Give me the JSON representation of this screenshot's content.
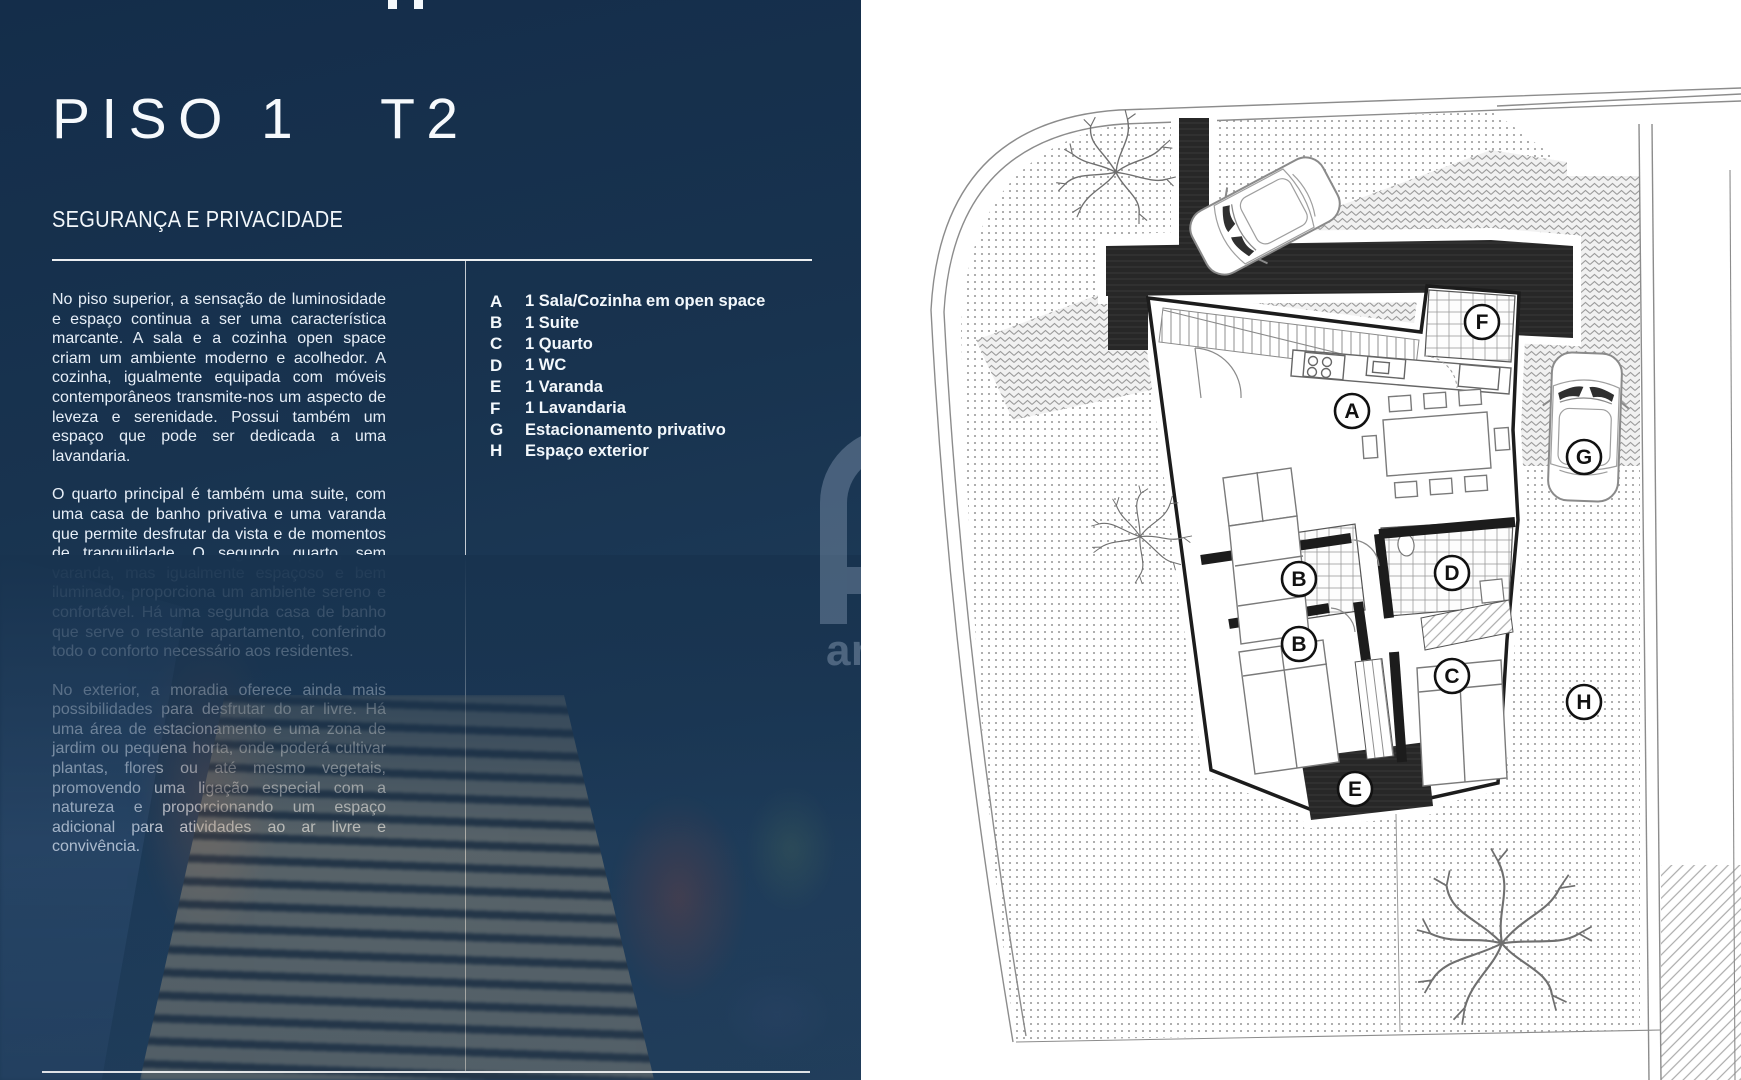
{
  "panel": {
    "title": {
      "left": "PISO 1",
      "right": "T2"
    },
    "subtitle": "SEGURANÇA E PRIVACIDADE",
    "paragraphs": [
      "No piso superior, a sensação de luminosidade e espaço continua a ser uma característica marcante. A sala e a cozinha open space criam um ambiente moderno e acolhedor. A cozinha, igualmente equipada com móveis contemporâneos transmite-nos um aspecto de leveza e serenidade. Possui também um espaço que pode ser dedicada a uma lavandaria.",
      "O quarto principal é também uma suite, com uma casa de banho privativa e uma varanda que permite desfrutar da vista e de momentos de tranquilidade. O segundo quarto, sem varanda, mas igualmente espaçoso e bem iluminado, proporciona um ambiente sereno e confortável. Há uma segunda casa de banho que serve o restante apartamento, conferindo todo o conforto necessário aos residentes.",
      "No exterior, a moradia oferece ainda mais possibilidades para desfrutar do ar livre. Há uma área de estacionamento e uma zona de jardim ou pequena horta, onde poderá cultivar plantas, flores ou até mesmo vegetais, promovendo uma ligação especial com a natureza e proporcionando um espaço adicional para atividades ao ar livre e convivência."
    ],
    "legend": [
      {
        "key": "A",
        "label": "1 Sala/Cozinha em open space"
      },
      {
        "key": "B",
        "label": "1 Suite"
      },
      {
        "key": "C",
        "label": "1 Quarto"
      },
      {
        "key": "D",
        "label": "1 WC"
      },
      {
        "key": "E",
        "label": "1 Varanda"
      },
      {
        "key": "F",
        "label": "1 Lavandaria"
      },
      {
        "key": "G",
        "label": "Estacionamento privativo"
      },
      {
        "key": "H",
        "label": "Espaço exterior"
      }
    ],
    "watermark_text": "an",
    "colors": {
      "panel_navy": "#18334f",
      "text_white": "#f3f8fc"
    }
  },
  "plan": {
    "labels": [
      {
        "key": "A"
      },
      {
        "key": "F"
      },
      {
        "key": "G"
      },
      {
        "key": "B"
      },
      {
        "key": "D"
      },
      {
        "key": "B"
      },
      {
        "key": "C"
      },
      {
        "key": "H"
      },
      {
        "key": "E"
      }
    ]
  }
}
